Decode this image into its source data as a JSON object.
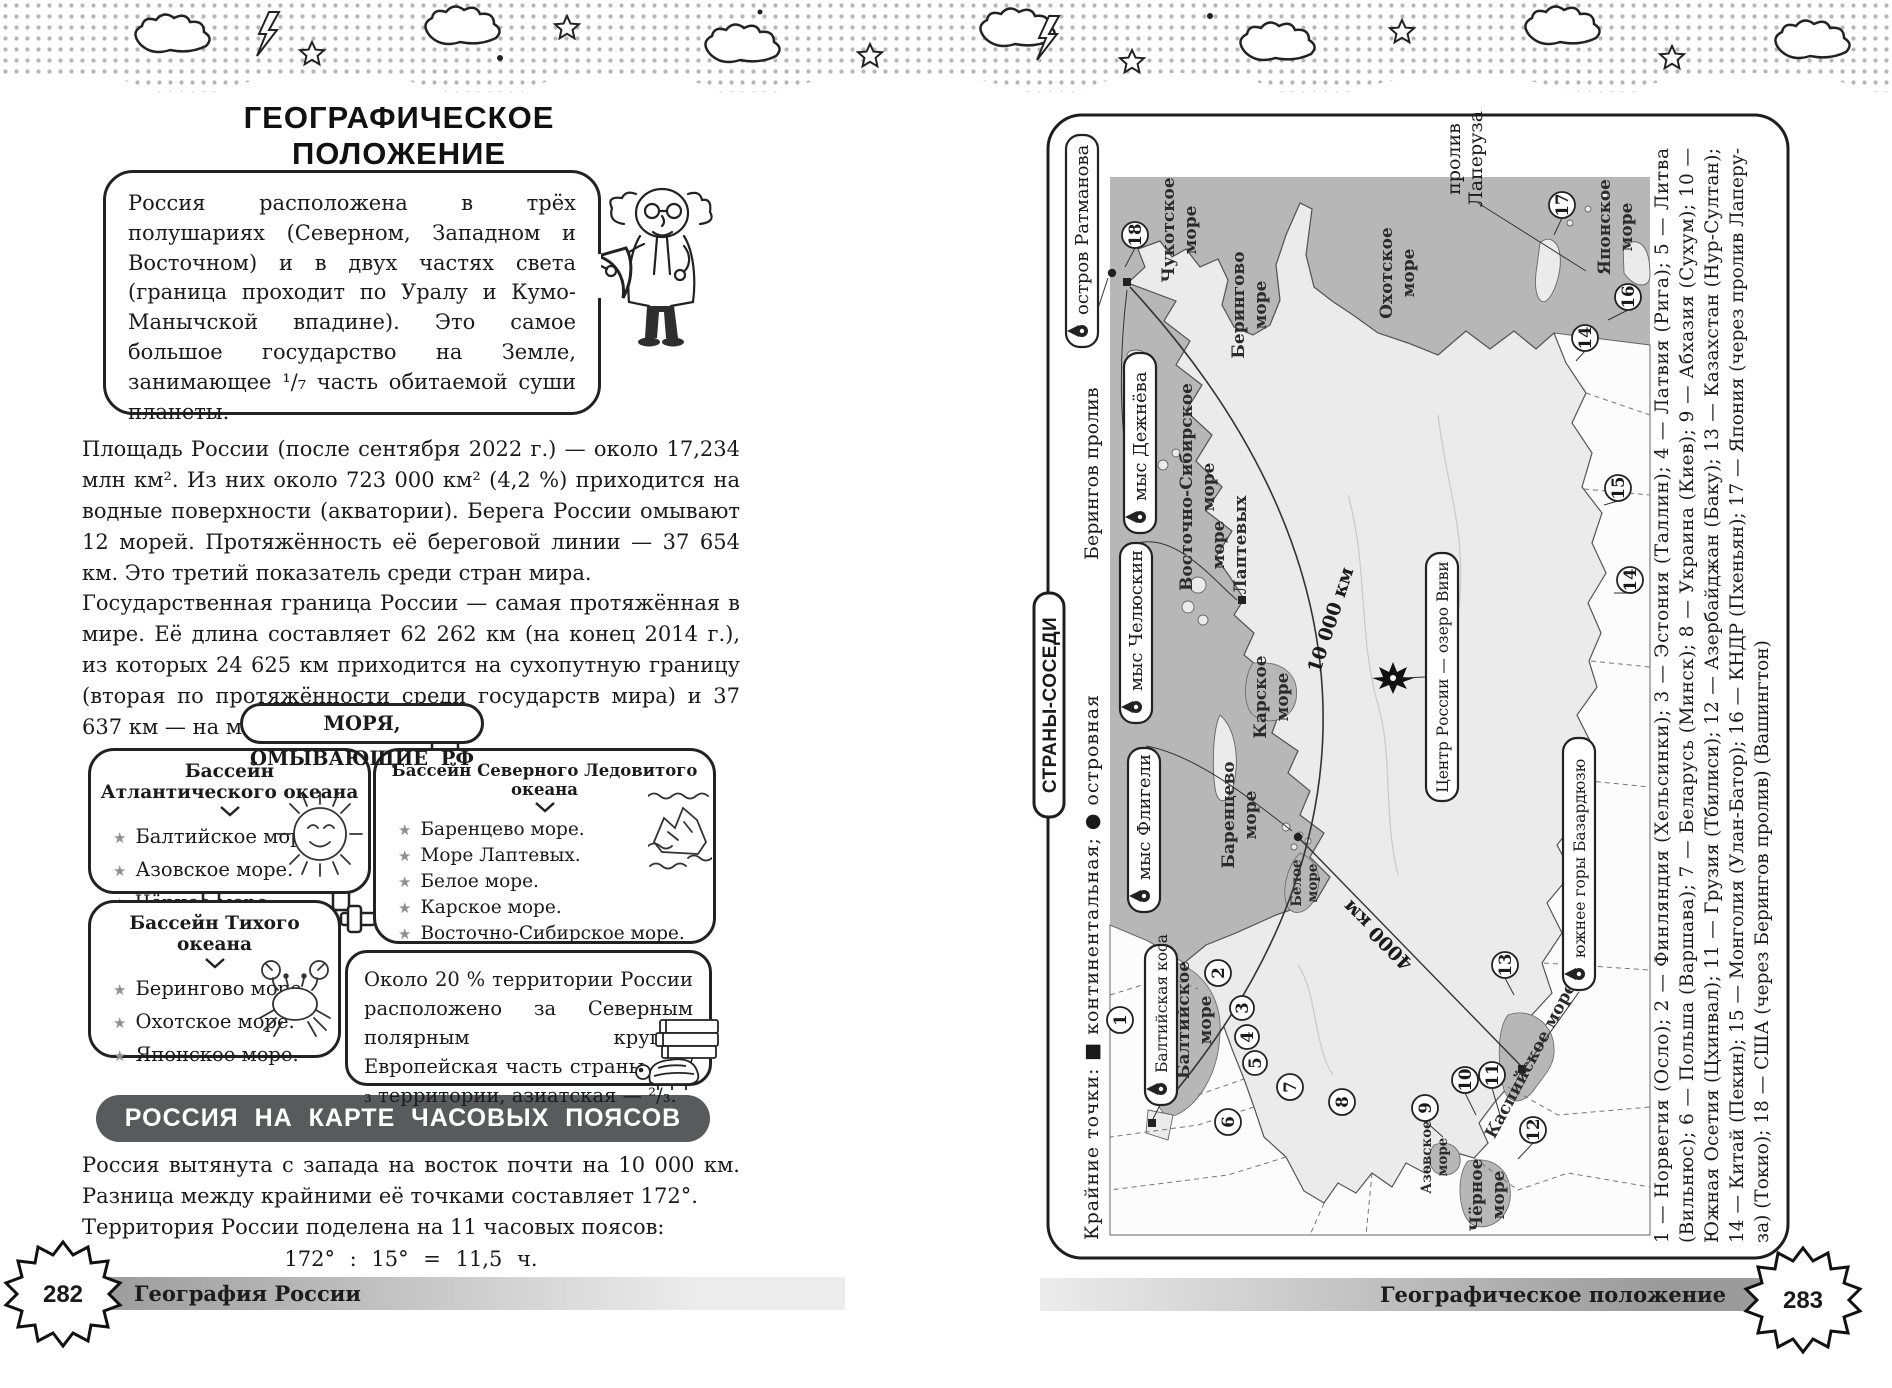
{
  "page_left": {
    "page_number": "282",
    "footer_label": "География  России",
    "title": "ГЕОГРАФИЧЕСКОЕ  ПОЛОЖЕНИЕ",
    "intro_bubble": "Россия расположена в трёх полушариях (Северном, Западном и Восточном) и в двух частях света (граница проходит по Уралу и Кумо-Манычской впадине). Это самое большое государство на Земле, занимающее ¹/₇ часть обитаемой суши планеты.",
    "para_area": "Площадь России (после сентября 2022 г.) — около 17,234 млн км². Из них около 723 000 км² (4,2 %) приходится на водные поверхности (акватории). Берега России омывают 12 морей. Протяжённость её береговой линии — 37 654 км. Это третий показатель среди стран мира.",
    "para_border": "Государственная граница России — самая протяжённая в мире. Её длина составляет 62 262 км (на конец 2014 г.), из которых 24 625 км приходится на сухопутную границу (вторая по протяжённости среди государств мира) и 37 637 км — на морскую.",
    "seas_title": "МОРЯ,  ОМЫВАЮЩИЕ  РФ",
    "basins": [
      {
        "title": "Бассейн  Атлантического  океана",
        "items": [
          "Балтийское  море.",
          "Азовское  море.",
          "Чёрное  море."
        ]
      },
      {
        "title": "Бассейн  Северного  Ледовитого  океана",
        "items": [
          "Баренцево  море.",
          "Море  Лаптевых.",
          "Белое  море.",
          "Карское  море.",
          "Восточно-Сибирское  море.",
          "Чукотское  море."
        ]
      },
      {
        "title": "Бассейн  Тихого  океана",
        "items": [
          "Берингово  море.",
          "Охотское  море.",
          "Японское  море."
        ]
      }
    ],
    "polar_note": "Около 20 % территории России расположено за Северным полярным кругом. Европейская часть страны — ¹/₃ территории, азиатская — ²/₃.",
    "timezone_banner": "РОССИЯ  НА  КАРТЕ  ЧАСОВЫХ  ПОЯСОВ",
    "timezone_para1": "Россия вытянута с запада на восток почти на 10 000 км. Разница между крайними её точками составляет 172°.",
    "timezone_para2": "Территория России поделена на 11 часовых поясов:",
    "timezone_formula": "172° : 15° = 11,5 ч."
  },
  "page_right": {
    "page_number": "283",
    "footer_label": "Географическое  положение",
    "sidebar_tab": "СТРАНЫ-СОСЕДИ",
    "legend": "Крайние  точки:  ■ континентальная;  ● островная",
    "labels": {
      "bering_strait": "Берингов  пролив",
      "laperouse_1": "пролив",
      "laperouse_2": "Лаперуза",
      "ratmanov": "остров  Ратманова",
      "dezhnev": "мыс  Дежнёва",
      "chelyuskin": "мыс  Челюскин",
      "fligely": "мыс  Флигели",
      "baltic_spit": "Балтийская  коса",
      "bazarduzu": "южнее горы Базардюзю",
      "center": "Центр России — озеро Виви",
      "dist_ew": "10 000  км",
      "dist_ns": "4000  км"
    },
    "seas": {
      "chukchi": [
        "Чукотское",
        "море"
      ],
      "bering": [
        "Берингово",
        "море"
      ],
      "east_siberian": [
        "Восточно-Сибирское",
        "море"
      ],
      "laptev": [
        "море",
        "Лаптевых"
      ],
      "okhotsk": [
        "Охотское",
        "море"
      ],
      "japan": [
        "Японское",
        "море"
      ],
      "kara": [
        "Карское",
        "море"
      ],
      "barents": [
        "Баренцево",
        "море"
      ],
      "white": [
        "Белое",
        "море"
      ],
      "baltic": [
        "Балтийское",
        "море"
      ],
      "azov": [
        "Азовское",
        "море"
      ],
      "black": [
        "Чёрное",
        "море"
      ],
      "caspian": "Каспийское море"
    },
    "circled": [
      "1",
      "2",
      "3",
      "4",
      "5",
      "6",
      "7",
      "8",
      "9",
      "10",
      "11",
      "12",
      "13",
      "14",
      "15",
      "16",
      "17",
      "18",
      "14"
    ],
    "countries": [
      "1 — Норвегия (Осло); 2 — Финляндия (Хельсинки); 3 — Эстония (Таллин); 4 — Латвия (Рига); 5 — Литва",
      "(Вильнюс); 6 — Польша (Варшава); 7 — Беларусь (Минск); 8 — Украина (Киев); 9 — Абхазия (Сухум); 10 —",
      "Южная Осетия (Цхинвал); 11 — Грузия (Тбилиси); 12 — Азербайджан (Баку); 13 — Казахстан (Нур-Султан);",
      "14 — Китай (Пекин); 15 — Монголия (Улан-Батор); 16 — КНДР (Пхеньян); 17 — Япония (через пролив Лаперу-",
      "за) (Токио); 18 — США (через Берингов пролив) (Вашингтон)"
    ]
  }
}
